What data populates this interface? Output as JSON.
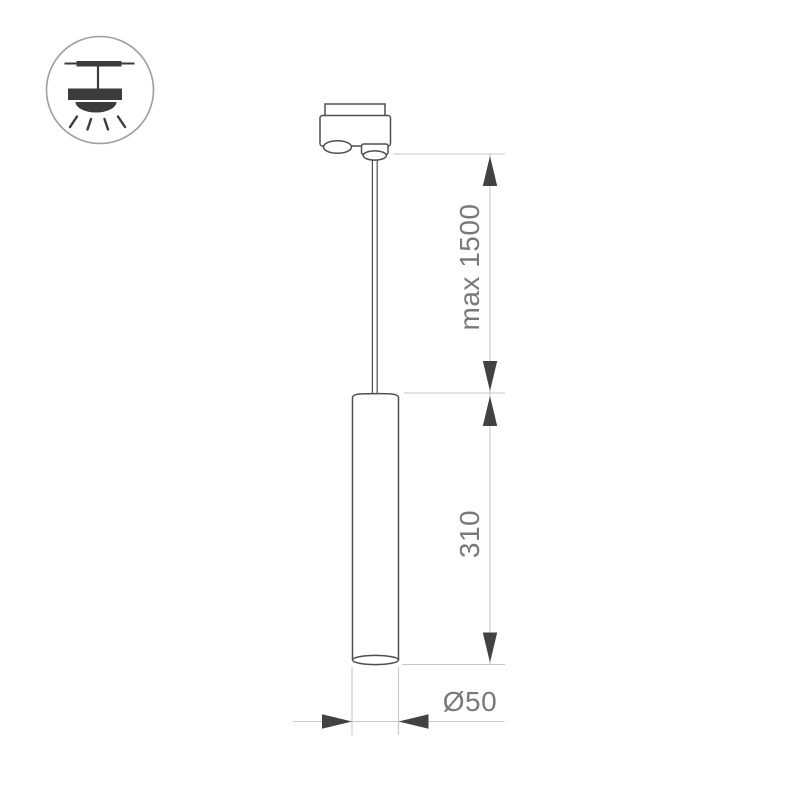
{
  "drawing": {
    "kind": "pendant-track-light-dimension-diagram",
    "dimensions": {
      "suspension_label": "max 1500",
      "body_height_label": "310",
      "diameter_label": "Ø50"
    },
    "icons": {
      "pendant_lamp": "pendant-lamp-icon"
    },
    "colors": {
      "outline": "#4d4f52",
      "dim-line": "#c6c8c9",
      "arrow": "#404244",
      "label": "#77797b",
      "icon-stroke": "#9c9ea0",
      "icon-fill": "#3a3c3e",
      "bg": "#ffffff"
    }
  }
}
